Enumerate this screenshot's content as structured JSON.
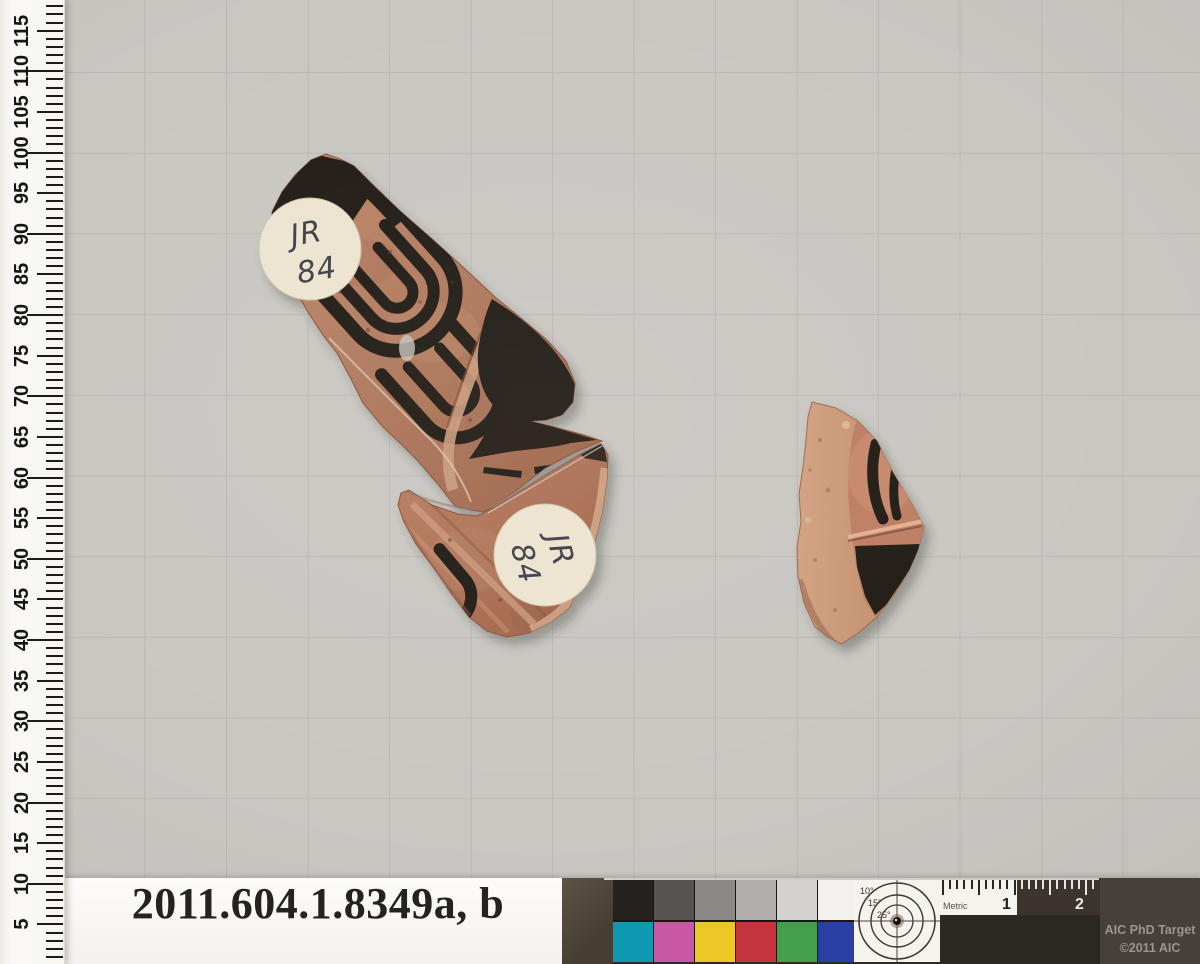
{
  "palette": {
    "bg": "#c9c7c2",
    "grid": "#b6b4af",
    "terr_light": "#c08a6d",
    "terr": "#b0795d",
    "terr_dark": "#9c6448",
    "glaze": "#211b16",
    "cream": "#ece4d0",
    "ink": "#41414b",
    "buff": "#d2a080",
    "buff_dark": "#bd8a66",
    "inner_face": "#bd7e63"
  },
  "ruler": {
    "min": 0,
    "max": 118,
    "px_per_unit": 8.124,
    "origin_bottom_px": 965,
    "number_step": 5,
    "numbers": [
      "5",
      "10",
      "15",
      "20",
      "25",
      "30",
      "35",
      "40",
      "45",
      "50",
      "55",
      "60",
      "65",
      "70",
      "75",
      "80",
      "85",
      "90",
      "95",
      "100",
      "105",
      "110",
      "115"
    ]
  },
  "specimen_labels": {
    "a": {
      "line1": "JR",
      "line2": "84"
    },
    "b": {
      "line1": "JR",
      "line2": "84"
    }
  },
  "caption": {
    "accession": "2011.604.1.8349a, b"
  },
  "target": {
    "grays": [
      "#24211e",
      "#565450",
      "#8b8987",
      "#b1afad",
      "#d5d3d0",
      "#f3f1ee"
    ],
    "colors": [
      "#0d9ab0",
      "#c958a2",
      "#ecc827",
      "#c5343f",
      "#42a04b",
      "#2a3fa4"
    ],
    "bullseye_labels": [
      "10°",
      "15°",
      "25°"
    ],
    "metric_label": "Metric",
    "mark_1": "1",
    "mark_2": "2",
    "credit_line1": "AIC PhD Target",
    "credit_line2": "©2011 AIC",
    "metric": {
      "mm_count": 21,
      "px_per_mm": 7.15,
      "major_every": 5
    }
  }
}
